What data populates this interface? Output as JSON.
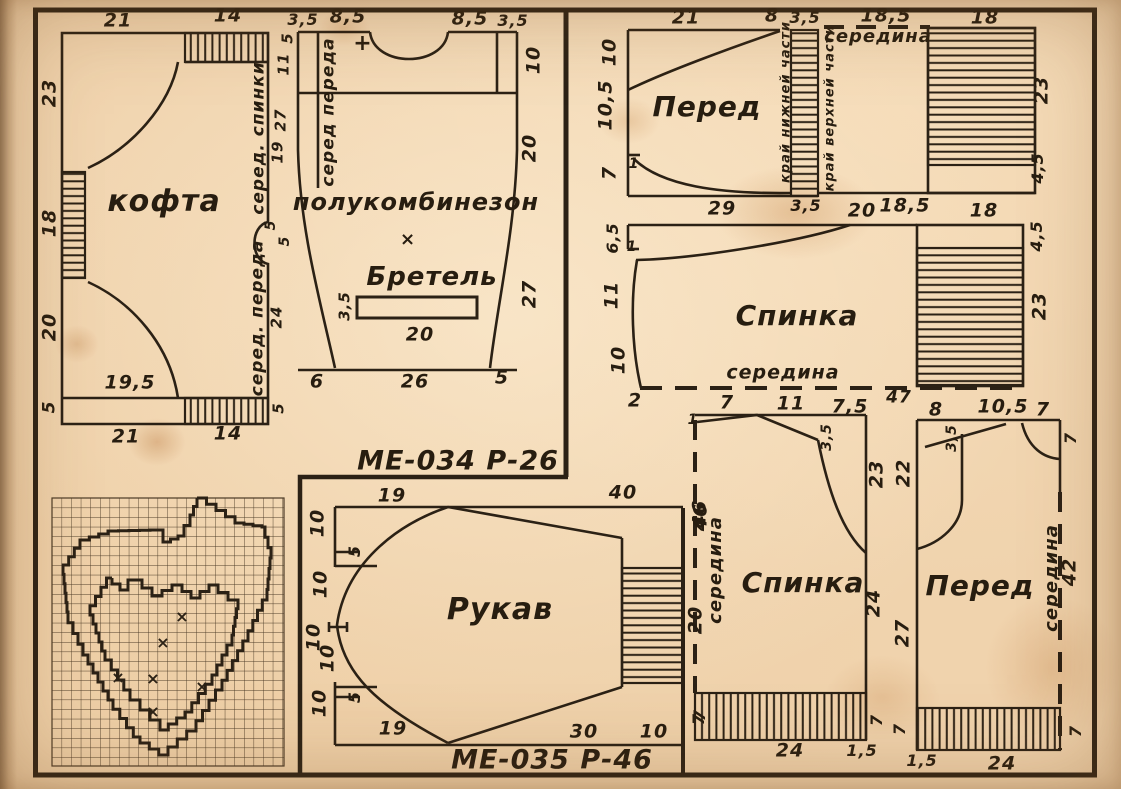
{
  "palette": {
    "paper": "#f0d3ad",
    "ink": "#2b2115"
  },
  "annotations": [
    {
      "t": "21",
      "x": 118,
      "y": 21
    },
    {
      "t": "14",
      "x": 228,
      "y": 16
    },
    {
      "t": "23",
      "x": 50,
      "y": 93,
      "r": -90
    },
    {
      "t": "18",
      "x": 50,
      "y": 223,
      "r": -90
    },
    {
      "t": "20",
      "x": 50,
      "y": 327,
      "r": -90
    },
    {
      "t": "5",
      "x": 50,
      "y": 407,
      "r": -90,
      "s": 17
    },
    {
      "t": "кофта",
      "x": 164,
      "y": 202,
      "s": 30,
      "n": "piece-name-kofta"
    },
    {
      "t": "19,5",
      "x": 130,
      "y": 383
    },
    {
      "t": "21",
      "x": 126,
      "y": 437
    },
    {
      "t": "14",
      "x": 228,
      "y": 434
    },
    {
      "t": "серед. спинки",
      "x": 259,
      "y": 138,
      "r": -90,
      "s": 17,
      "n": "fold-label"
    },
    {
      "t": "серед. переда",
      "x": 258,
      "y": 318,
      "r": -90,
      "s": 17,
      "n": "fold-label"
    },
    {
      "t": "5",
      "x": 288,
      "y": 38,
      "r": -90,
      "s": 15
    },
    {
      "t": "11",
      "x": 284,
      "y": 64,
      "r": -90,
      "s": 15
    },
    {
      "t": "27",
      "x": 281,
      "y": 120,
      "r": -90,
      "s": 15
    },
    {
      "t": "19",
      "x": 278,
      "y": 152,
      "r": -90,
      "s": 15
    },
    {
      "t": "5",
      "x": 271,
      "y": 225,
      "r": -90,
      "s": 14
    },
    {
      "t": "5",
      "x": 285,
      "y": 241,
      "r": -90,
      "s": 14
    },
    {
      "t": "24",
      "x": 277,
      "y": 317,
      "r": -90,
      "s": 15
    },
    {
      "t": "5",
      "x": 279,
      "y": 408,
      "r": -90,
      "s": 15
    },
    {
      "t": "3,5",
      "x": 303,
      "y": 20,
      "s": 16
    },
    {
      "t": "8,5",
      "x": 348,
      "y": 17
    },
    {
      "t": "8,5",
      "x": 470,
      "y": 19
    },
    {
      "t": "3,5",
      "x": 513,
      "y": 21,
      "s": 16
    },
    {
      "t": "10",
      "x": 534,
      "y": 60,
      "r": -90
    },
    {
      "t": "20",
      "x": 530,
      "y": 148,
      "r": -90
    },
    {
      "t": "27",
      "x": 530,
      "y": 294,
      "r": -90
    },
    {
      "t": "серед переда",
      "x": 329,
      "y": 112,
      "r": -90,
      "s": 17,
      "n": "fold-label"
    },
    {
      "t": "+",
      "x": 363,
      "y": 44,
      "s": 22,
      "n": "match-mark"
    },
    {
      "t": "полукомбинезон",
      "x": 416,
      "y": 202,
      "s": 24,
      "n": "piece-name-polukombinezon"
    },
    {
      "t": "×",
      "x": 408,
      "y": 240,
      "s": 18,
      "n": "match-mark"
    },
    {
      "t": "Бретель",
      "x": 432,
      "y": 277,
      "s": 26,
      "n": "piece-name-bretel"
    },
    {
      "t": "3,5",
      "x": 345,
      "y": 306,
      "r": -90,
      "s": 15
    },
    {
      "t": "20",
      "x": 420,
      "y": 335
    },
    {
      "t": "6",
      "x": 317,
      "y": 382
    },
    {
      "t": "26",
      "x": 415,
      "y": 382
    },
    {
      "t": "5",
      "x": 502,
      "y": 378
    },
    {
      "t": "МЕ-034 Р-26",
      "x": 458,
      "y": 461,
      "s": 27,
      "n": "sheet-code-1"
    },
    {
      "t": "21",
      "x": 686,
      "y": 18
    },
    {
      "t": "8",
      "x": 772,
      "y": 16
    },
    {
      "t": "3,5",
      "x": 805,
      "y": 18,
      "s": 16
    },
    {
      "t": "10",
      "x": 610,
      "y": 52,
      "r": -90
    },
    {
      "t": "10,5",
      "x": 606,
      "y": 105,
      "r": -90
    },
    {
      "t": "7",
      "x": 610,
      "y": 173,
      "r": -90
    },
    {
      "t": "1",
      "x": 634,
      "y": 164,
      "s": 14
    },
    {
      "t": "Перед",
      "x": 707,
      "y": 107,
      "s": 28,
      "n": "piece-name-pered-top"
    },
    {
      "t": "29",
      "x": 722,
      "y": 209
    },
    {
      "t": "3,5",
      "x": 806,
      "y": 206,
      "s": 16
    },
    {
      "t": "край нижней части",
      "x": 786,
      "y": 102,
      "r": -90,
      "s": 13,
      "n": "edge-label"
    },
    {
      "t": "край верхней части",
      "x": 830,
      "y": 108,
      "r": -90,
      "s": 13,
      "n": "edge-label"
    },
    {
      "t": "середина",
      "x": 878,
      "y": 37,
      "s": 18,
      "n": "fold-label"
    },
    {
      "t": "18,5",
      "x": 886,
      "y": 16
    },
    {
      "t": "18",
      "x": 985,
      "y": 18
    },
    {
      "t": "23",
      "x": 1042,
      "y": 90,
      "r": -90
    },
    {
      "t": "4,5",
      "x": 1038,
      "y": 168,
      "r": -90,
      "s": 16
    },
    {
      "t": "20",
      "x": 862,
      "y": 211
    },
    {
      "t": "18,5",
      "x": 905,
      "y": 206
    },
    {
      "t": "18",
      "x": 984,
      "y": 211
    },
    {
      "t": "6,5",
      "x": 613,
      "y": 238,
      "r": -90,
      "s": 16
    },
    {
      "t": "1",
      "x": 632,
      "y": 247,
      "s": 14
    },
    {
      "t": "11",
      "x": 612,
      "y": 295,
      "r": -90
    },
    {
      "t": "10",
      "x": 619,
      "y": 360,
      "r": -90
    },
    {
      "t": "Спинка",
      "x": 797,
      "y": 316,
      "s": 28,
      "n": "piece-name-spinka-mid"
    },
    {
      "t": "середина",
      "x": 783,
      "y": 373,
      "s": 19,
      "n": "fold-label"
    },
    {
      "t": "2",
      "x": 635,
      "y": 401
    },
    {
      "t": "47",
      "x": 899,
      "y": 398,
      "s": 17
    },
    {
      "t": "4,5",
      "x": 1037,
      "y": 236,
      "r": -90,
      "s": 16
    },
    {
      "t": "23",
      "x": 1040,
      "y": 306,
      "r": -90
    },
    {
      "t": "7",
      "x": 727,
      "y": 403
    },
    {
      "t": "11",
      "x": 791,
      "y": 404
    },
    {
      "t": "7,5",
      "x": 850,
      "y": 407
    },
    {
      "t": "8",
      "x": 936,
      "y": 410
    },
    {
      "t": "10,5",
      "x": 1003,
      "y": 407
    },
    {
      "t": "7",
      "x": 1043,
      "y": 410
    },
    {
      "t": "1",
      "x": 693,
      "y": 420,
      "s": 14
    },
    {
      "t": "3,5",
      "x": 827,
      "y": 437,
      "r": -90,
      "s": 14
    },
    {
      "t": "46",
      "x": 701,
      "y": 517,
      "r": -90
    },
    {
      "t": "середина",
      "x": 716,
      "y": 570,
      "r": -90,
      "s": 18,
      "n": "fold-label"
    },
    {
      "t": "Спинка",
      "x": 803,
      "y": 583,
      "s": 28,
      "n": "piece-name-spinka-bottom"
    },
    {
      "t": "23",
      "x": 877,
      "y": 474,
      "r": -90
    },
    {
      "t": "24",
      "x": 874,
      "y": 603,
      "r": -90
    },
    {
      "t": "7",
      "x": 699,
      "y": 719,
      "r": -90,
      "s": 16
    },
    {
      "t": "7",
      "x": 877,
      "y": 720,
      "r": -90,
      "s": 16
    },
    {
      "t": "24",
      "x": 790,
      "y": 751
    },
    {
      "t": "1,5",
      "x": 862,
      "y": 751,
      "s": 16
    },
    {
      "t": "22",
      "x": 904,
      "y": 473,
      "r": -90
    },
    {
      "t": "27",
      "x": 903,
      "y": 633,
      "r": -90
    },
    {
      "t": "3,5",
      "x": 952,
      "y": 438,
      "r": -90,
      "s": 14
    },
    {
      "t": "7",
      "x": 1071,
      "y": 438,
      "r": -90,
      "s": 16
    },
    {
      "t": "Перед",
      "x": 980,
      "y": 586,
      "s": 28,
      "n": "piece-name-pered-bottom"
    },
    {
      "t": "середина",
      "x": 1052,
      "y": 578,
      "r": -90,
      "s": 18,
      "n": "fold-label"
    },
    {
      "t": "42",
      "x": 1070,
      "y": 572,
      "r": -90
    },
    {
      "t": "7",
      "x": 900,
      "y": 729,
      "r": -90,
      "s": 16
    },
    {
      "t": "7",
      "x": 1076,
      "y": 731,
      "r": -90,
      "s": 16
    },
    {
      "t": "1,5",
      "x": 922,
      "y": 761,
      "s": 16
    },
    {
      "t": "24",
      "x": 1002,
      "y": 764
    },
    {
      "t": "19",
      "x": 392,
      "y": 496
    },
    {
      "t": "40",
      "x": 623,
      "y": 493
    },
    {
      "t": "10",
      "x": 318,
      "y": 523,
      "r": -90
    },
    {
      "t": "5",
      "x": 355,
      "y": 551,
      "r": -90,
      "s": 16
    },
    {
      "t": "10",
      "x": 321,
      "y": 584,
      "r": -90
    },
    {
      "t": "10",
      "x": 314,
      "y": 637,
      "r": -90
    },
    {
      "t": "10",
      "x": 328,
      "y": 658,
      "r": -90
    },
    {
      "t": "5",
      "x": 355,
      "y": 697,
      "r": -90,
      "s": 16
    },
    {
      "t": "10",
      "x": 320,
      "y": 703,
      "r": -90
    },
    {
      "t": "19",
      "x": 393,
      "y": 729
    },
    {
      "t": "Рукав",
      "x": 500,
      "y": 610,
      "s": 30,
      "n": "piece-name-rukav"
    },
    {
      "t": "46",
      "x": 700,
      "y": 514,
      "r": -90
    },
    {
      "t": "20",
      "x": 696,
      "y": 620,
      "r": -90
    },
    {
      "t": "7",
      "x": 700,
      "y": 715,
      "r": -90,
      "s": 16
    },
    {
      "t": "30",
      "x": 584,
      "y": 732
    },
    {
      "t": "10",
      "x": 654,
      "y": 732
    },
    {
      "t": "МЕ-035 Р-46",
      "x": 552,
      "y": 760,
      "s": 27,
      "n": "sheet-code-2"
    }
  ],
  "embroidery_chart": {
    "grid": {
      "x": 52,
      "y": 498,
      "w": 232,
      "h": 268,
      "cell": 9.6
    },
    "outer": [
      [
        197,
        498
      ],
      [
        235,
        523
      ],
      [
        262,
        527
      ],
      [
        271,
        558
      ],
      [
        267,
        600
      ],
      [
        248,
        641
      ],
      [
        222,
        690
      ],
      [
        196,
        731
      ],
      [
        168,
        755
      ],
      [
        140,
        737
      ],
      [
        113,
        700
      ],
      [
        88,
        655
      ],
      [
        68,
        612
      ],
      [
        63,
        565
      ],
      [
        80,
        540
      ],
      [
        108,
        531
      ],
      [
        150,
        530
      ],
      [
        163,
        542
      ],
      [
        178,
        536
      ],
      [
        190,
        515
      ],
      [
        197,
        498
      ]
    ],
    "inner": [
      [
        112,
        578
      ],
      [
        90,
        615
      ],
      [
        105,
        660
      ],
      [
        130,
        700
      ],
      [
        160,
        730
      ],
      [
        185,
        712
      ],
      [
        212,
        675
      ],
      [
        232,
        635
      ],
      [
        238,
        600
      ],
      [
        218,
        585
      ],
      [
        200,
        598
      ],
      [
        182,
        585
      ],
      [
        162,
        596
      ],
      [
        142,
        580
      ],
      [
        128,
        590
      ],
      [
        112,
        578
      ]
    ],
    "marks": [
      [
        163,
        643
      ],
      [
        118,
        678
      ],
      [
        153,
        679
      ],
      [
        202,
        687
      ],
      [
        153,
        712
      ],
      [
        182,
        617
      ]
    ]
  }
}
